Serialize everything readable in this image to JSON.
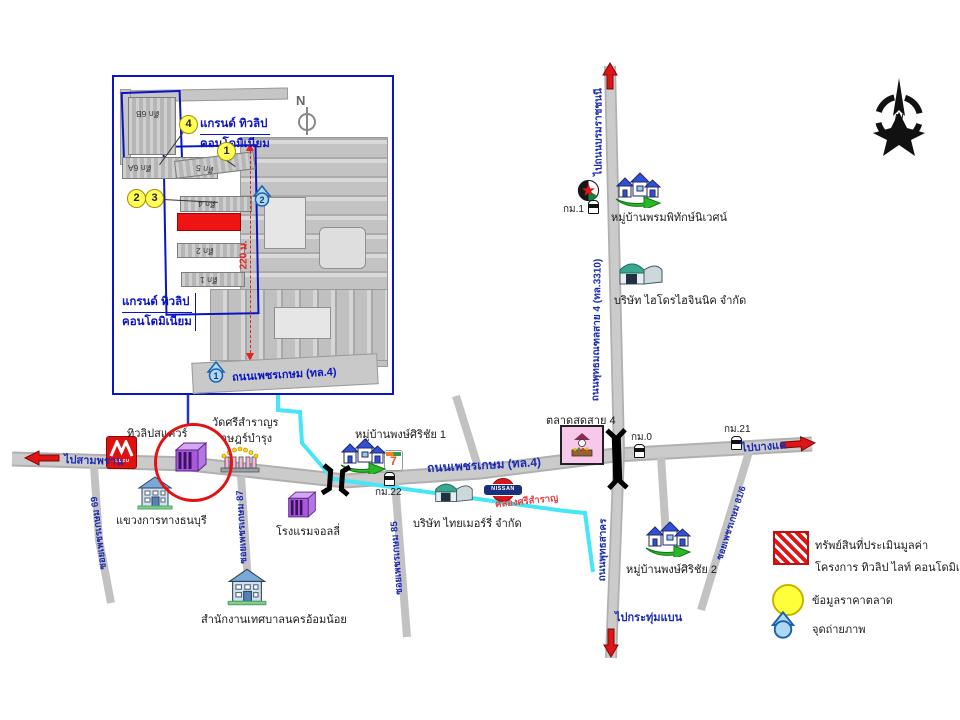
{
  "compass_n": "N",
  "colors": {
    "highlight_red": "#e01414",
    "canal_cyan": "#45e6f6",
    "inset_border_blue": "#0a14c0",
    "road_grey": "#c9c9c9",
    "building_purple": "#a858d8",
    "legend_yellow": "#ffff3a",
    "photo_point_blue": "#aed7f2"
  },
  "logos": {
    "nissan": "NISSAN",
    "isuzu": "ISUZU",
    "seven": "7"
  },
  "inset": {
    "north": "N",
    "project_line1": "แกรนด์ ทิวลิป",
    "project_line2": "คอนโดมิเนียม",
    "road": "ถนนเพชรเกษม (ทล.4)",
    "distance": "220 ม.",
    "bldg_6b": "ตึก 6B",
    "bldg_6a": "ตึก 6A",
    "bldg_5": "ตึก 5",
    "bldg_4": "ตึก 4",
    "bldg_2": "ตึก 2",
    "bldg_1": "ตึก 1",
    "num1": "1",
    "num2": "2",
    "num3": "3",
    "num4": "4",
    "photo1": "1",
    "photo2": "2"
  },
  "map": {
    "roads": {
      "phetkasem": "ถนนเพชรเกษม (ทล.4)",
      "sai4": "ถนนพุทธมณฑลสาย 4 (ทล.3310)",
      "phutthasakhon": "ถนนพุทธสาคร",
      "soi69": "ซอยเพชรเกษม 69",
      "soi87": "ซอยเพชรเกษม 87",
      "soi85": "ซอยเพชรเกษม 85",
      "soi81_6": "ซอยเพชรเกษม 81/6",
      "to_sampran": "ไปสามพราน",
      "to_bangkhae": "ไปบางแค",
      "to_borom": "ไปถนนบรมราชชนนี",
      "to_krathumbaen": "ไปกระทุ่มแบน"
    },
    "canal": "คลองศรีสำราญ",
    "km": {
      "km0": "กม.0",
      "km1": "กม.1",
      "km21": "กม.21",
      "km22": "กม.22"
    },
    "places": {
      "tulip_square": "ทิวลิปสแควร์",
      "temple1": "วัดศรีสำราญร",
      "temple2": "าษฎร์บำรุง",
      "highway_office": "แขวงการทางธนบุรี",
      "jolly": "โรงแรมจอลลี่",
      "municipality": "สำนักงานเทศบาลนครอ้อมน้อย",
      "village1": "หมู่บ้านพงษ์ศิริชัย 1",
      "village2": "หมู่บ้านพงษ์ศิริชัย 2",
      "village3": "หมู่บ้านพรมพิทักษ์นิเวศน์",
      "thaimerry": "บริษัท ไทยเมอร์รี่ จำกัด",
      "hydro": "บริษัท ไฮโดรไฮจินนิค จำกัด",
      "market": "ตลาดสดสาย 4"
    }
  },
  "legend": {
    "item1_line1": "ทรัพย์สินที่ประเมินมูลค่า",
    "item1_line2": "โครงการ ทิวลิป ไลท์ คอนโดมิเนียม",
    "item2": "ข้อมูลราคาตลาด",
    "item3": "จุดถ่ายภาพ"
  }
}
